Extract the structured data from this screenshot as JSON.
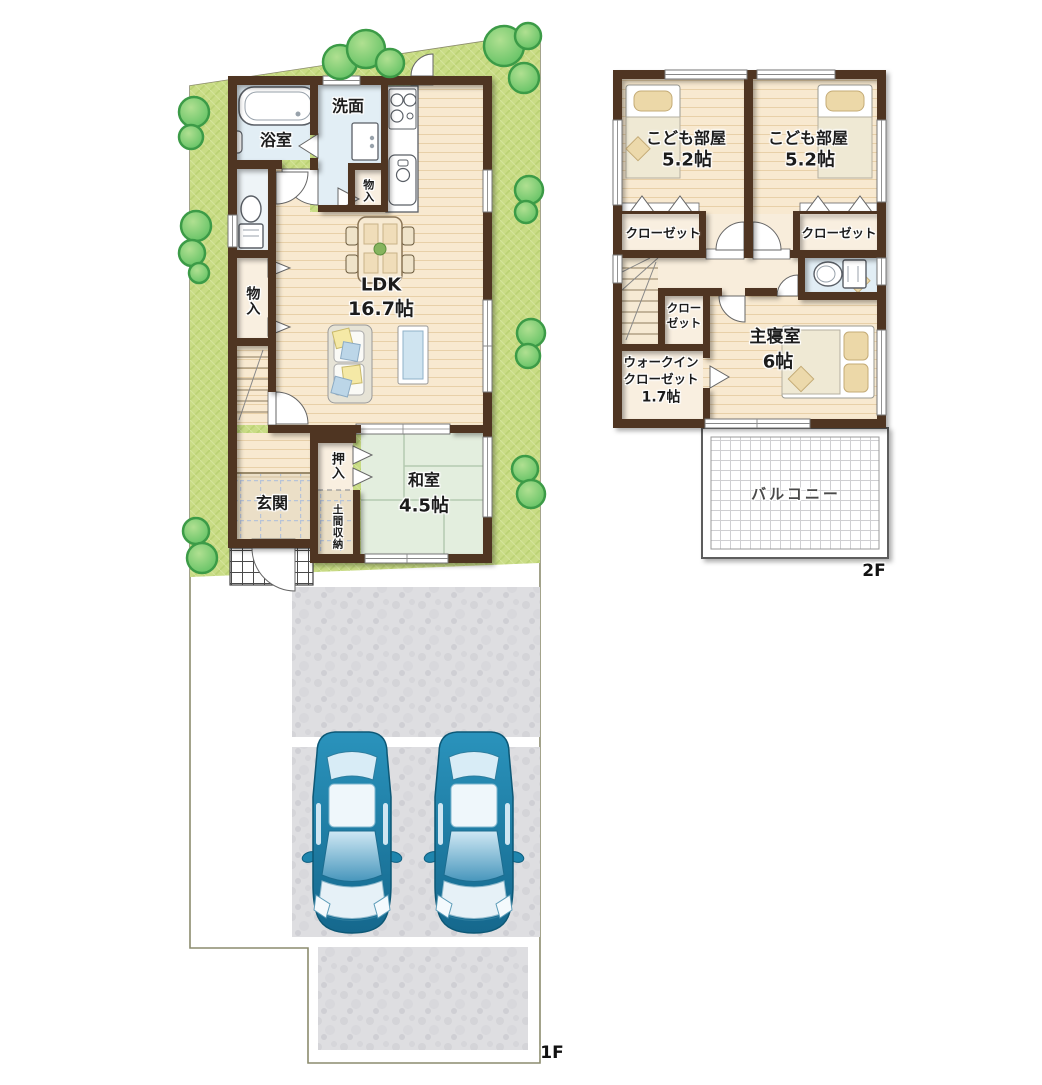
{
  "floor_labels": {
    "f1": "1F",
    "f2": "2F"
  },
  "f1": {
    "bath": "浴室",
    "washroom": "洗面",
    "storage_small": "物入",
    "storage_hall": "物入",
    "ldk_name": "LDK",
    "ldk_size": "16.7帖",
    "oshiire": "押入",
    "washitsu_name": "和室",
    "washitsu_size": "4.5帖",
    "genkan": "玄関",
    "doma": "土間収納"
  },
  "f2": {
    "kids1_name": "こども部屋",
    "kids1_size": "5.2帖",
    "kids2_name": "こども部屋",
    "kids2_size": "5.2帖",
    "closet_left": "クローゼット",
    "closet_right": "クローゼット",
    "closet_small_l1": "クロー",
    "closet_small_l2": "ゼット",
    "wic_l1": "ウォークイン",
    "wic_l2": "クローゼット",
    "wic_size": "1.7帖",
    "master_name": "主寝室",
    "master_size": "6帖",
    "balcony": "バルコニー"
  },
  "colors": {
    "wall": "#4f3423",
    "grass": "#c9dc85",
    "wood_floor": "#f8e9d0",
    "tatami": "#e3eede",
    "wet_area": "#e2eef5",
    "closet": "#f9efe0",
    "entrance_tile": "#ebdfc7",
    "concrete": "#dedee1",
    "car_body": "#1f85ad",
    "tree": "#82cf70"
  }
}
